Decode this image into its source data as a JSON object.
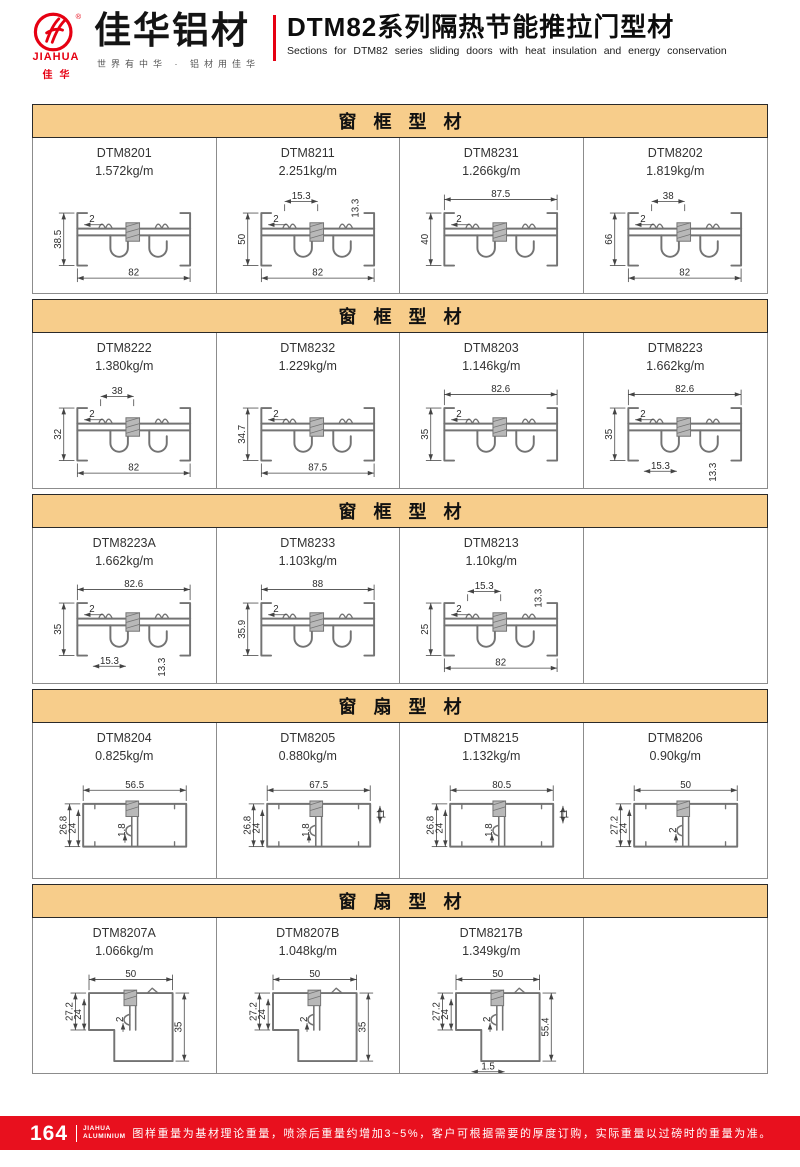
{
  "colors": {
    "accent_red": "#e8101e",
    "logo_red": "#e60012",
    "section_header_bg": "#f7cd8b"
  },
  "header": {
    "logo": {
      "brand_en": "JIAHUA",
      "brand_short": "佳华",
      "brand_cn": "佳华铝材",
      "registered": "®",
      "slogan": "世界有中华 · 铝材用佳华"
    },
    "title_cn": "DTM82系列隔热节能推拉门型材",
    "title_en": "Sections for DTM82 series sliding doors with heat insulation and energy conservation"
  },
  "sections": [
    {
      "title": "窗框型材",
      "cells": [
        {
          "code": "DTM8201",
          "weight": "1.572kg/m",
          "shape": "frame",
          "dims": [
            {
              "v": "38.5",
              "pos": "left"
            },
            {
              "v": "2",
              "pos": "inner"
            },
            {
              "v": "82",
              "pos": "bottom"
            }
          ]
        },
        {
          "code": "DTM8211",
          "weight": "2.251kg/m",
          "shape": "frame",
          "dims": [
            {
              "v": "15.3",
              "pos": "short-top"
            },
            {
              "v": "13.3",
              "pos": "vert-top"
            },
            {
              "v": "50",
              "pos": "left"
            },
            {
              "v": "2",
              "pos": "inner"
            },
            {
              "v": "82",
              "pos": "bottom"
            }
          ]
        },
        {
          "code": "DTM8231",
          "weight": "1.266kg/m",
          "shape": "frame",
          "dims": [
            {
              "v": "87.5",
              "pos": "top"
            },
            {
              "v": "40",
              "pos": "left"
            },
            {
              "v": "2",
              "pos": "inner"
            }
          ]
        },
        {
          "code": "DTM8202",
          "weight": "1.819kg/m",
          "shape": "frame",
          "dims": [
            {
              "v": "38",
              "pos": "short-top"
            },
            {
              "v": "66",
              "pos": "left"
            },
            {
              "v": "2",
              "pos": "inner"
            },
            {
              "v": "82",
              "pos": "bottom"
            }
          ]
        }
      ]
    },
    {
      "title": "窗框型材",
      "cells": [
        {
          "code": "DTM8222",
          "weight": "1.380kg/m",
          "shape": "frame",
          "dims": [
            {
              "v": "38",
              "pos": "short-top"
            },
            {
              "v": "32",
              "pos": "left"
            },
            {
              "v": "2",
              "pos": "inner"
            },
            {
              "v": "82",
              "pos": "bottom"
            }
          ]
        },
        {
          "code": "DTM8232",
          "weight": "1.229kg/m",
          "shape": "frame",
          "dims": [
            {
              "v": "34.7",
              "pos": "left"
            },
            {
              "v": "2",
              "pos": "inner"
            },
            {
              "v": "87.5",
              "pos": "bottom"
            }
          ]
        },
        {
          "code": "DTM8203",
          "weight": "1.146kg/m",
          "shape": "frame",
          "dims": [
            {
              "v": "82.6",
              "pos": "top"
            },
            {
              "v": "35",
              "pos": "left"
            },
            {
              "v": "2",
              "pos": "inner"
            }
          ]
        },
        {
          "code": "DTM8223",
          "weight": "1.662kg/m",
          "shape": "frame",
          "dims": [
            {
              "v": "82.6",
              "pos": "top"
            },
            {
              "v": "35",
              "pos": "left"
            },
            {
              "v": "2",
              "pos": "inner"
            },
            {
              "v": "15.3",
              "pos": "short-bottom"
            },
            {
              "v": "13.3",
              "pos": "vert-bottom"
            }
          ]
        }
      ]
    },
    {
      "title": "窗框型材",
      "cells": [
        {
          "code": "DTM8223A",
          "weight": "1.662kg/m",
          "shape": "frame",
          "dims": [
            {
              "v": "82.6",
              "pos": "top"
            },
            {
              "v": "35",
              "pos": "left"
            },
            {
              "v": "2",
              "pos": "inner"
            },
            {
              "v": "15.3",
              "pos": "short-bottom"
            },
            {
              "v": "13.3",
              "pos": "vert-bottom"
            }
          ]
        },
        {
          "code": "DTM8233",
          "weight": "1.103kg/m",
          "shape": "frame",
          "dims": [
            {
              "v": "88",
              "pos": "top"
            },
            {
              "v": "35.9",
              "pos": "left"
            },
            {
              "v": "2",
              "pos": "inner"
            }
          ]
        },
        {
          "code": "DTM8213",
          "weight": "1.10kg/m",
          "shape": "frame",
          "dims": [
            {
              "v": "15.3",
              "pos": "short-top"
            },
            {
              "v": "13.3",
              "pos": "vert-top"
            },
            {
              "v": "25",
              "pos": "left"
            },
            {
              "v": "2",
              "pos": "inner"
            },
            {
              "v": "82",
              "pos": "bottom"
            }
          ]
        },
        null
      ]
    },
    {
      "title": "窗扇型材",
      "cells": [
        {
          "code": "DTM8204",
          "weight": "0.825kg/m",
          "shape": "sash",
          "dims": [
            {
              "v": "56.5",
              "pos": "top"
            },
            {
              "v": "26.8",
              "pos": "left"
            },
            {
              "v": "24",
              "pos": "left2"
            },
            {
              "v": "1.8",
              "pos": "inner"
            }
          ]
        },
        {
          "code": "DTM8205",
          "weight": "0.880kg/m",
          "shape": "sash",
          "dims": [
            {
              "v": "67.5",
              "pos": "top"
            },
            {
              "v": "26.8",
              "pos": "left"
            },
            {
              "v": "24",
              "pos": "left2"
            },
            {
              "v": "1.8",
              "pos": "inner"
            },
            {
              "v": "11",
              "pos": "right-small"
            }
          ]
        },
        {
          "code": "DTM8215",
          "weight": "1.132kg/m",
          "shape": "sash",
          "dims": [
            {
              "v": "80.5",
              "pos": "top"
            },
            {
              "v": "26.8",
              "pos": "left"
            },
            {
              "v": "24",
              "pos": "left2"
            },
            {
              "v": "1.8",
              "pos": "inner"
            },
            {
              "v": "11",
              "pos": "right-small"
            }
          ]
        },
        {
          "code": "DTM8206",
          "weight": "0.90kg/m",
          "shape": "sash",
          "dims": [
            {
              "v": "50",
              "pos": "top"
            },
            {
              "v": "27.2",
              "pos": "left"
            },
            {
              "v": "24",
              "pos": "left2"
            },
            {
              "v": "2",
              "pos": "inner"
            }
          ]
        }
      ]
    },
    {
      "title": "窗扇型材",
      "cells": [
        {
          "code": "DTM8207A",
          "weight": "1.066kg/m",
          "shape": "sash-tall",
          "dims": [
            {
              "v": "50",
              "pos": "top"
            },
            {
              "v": "27.2",
              "pos": "left"
            },
            {
              "v": "24",
              "pos": "left2"
            },
            {
              "v": "2",
              "pos": "inner"
            },
            {
              "v": "35",
              "pos": "right"
            }
          ]
        },
        {
          "code": "DTM8207B",
          "weight": "1.048kg/m",
          "shape": "sash-tall",
          "dims": [
            {
              "v": "50",
              "pos": "top"
            },
            {
              "v": "27.2",
              "pos": "left"
            },
            {
              "v": "24",
              "pos": "left2"
            },
            {
              "v": "2",
              "pos": "inner"
            },
            {
              "v": "35",
              "pos": "right"
            }
          ]
        },
        {
          "code": "DTM8217B",
          "weight": "1.349kg/m",
          "shape": "sash-tall",
          "dims": [
            {
              "v": "50",
              "pos": "top"
            },
            {
              "v": "27.2",
              "pos": "left"
            },
            {
              "v": "24",
              "pos": "left2"
            },
            {
              "v": "2",
              "pos": "inner"
            },
            {
              "v": "55.4",
              "pos": "right"
            },
            {
              "v": "1.5",
              "pos": "short-bottom"
            }
          ]
        },
        null
      ]
    }
  ],
  "footer": {
    "page_number": "164",
    "brand_line1": "JIAHUA",
    "brand_line2": "ALUMINIUM",
    "note": "图样重量为基材理论重量，喷涂后重量约增加3~5%，客户可根据需要的厚度订购，实际重量以过磅时的重量为准。"
  }
}
